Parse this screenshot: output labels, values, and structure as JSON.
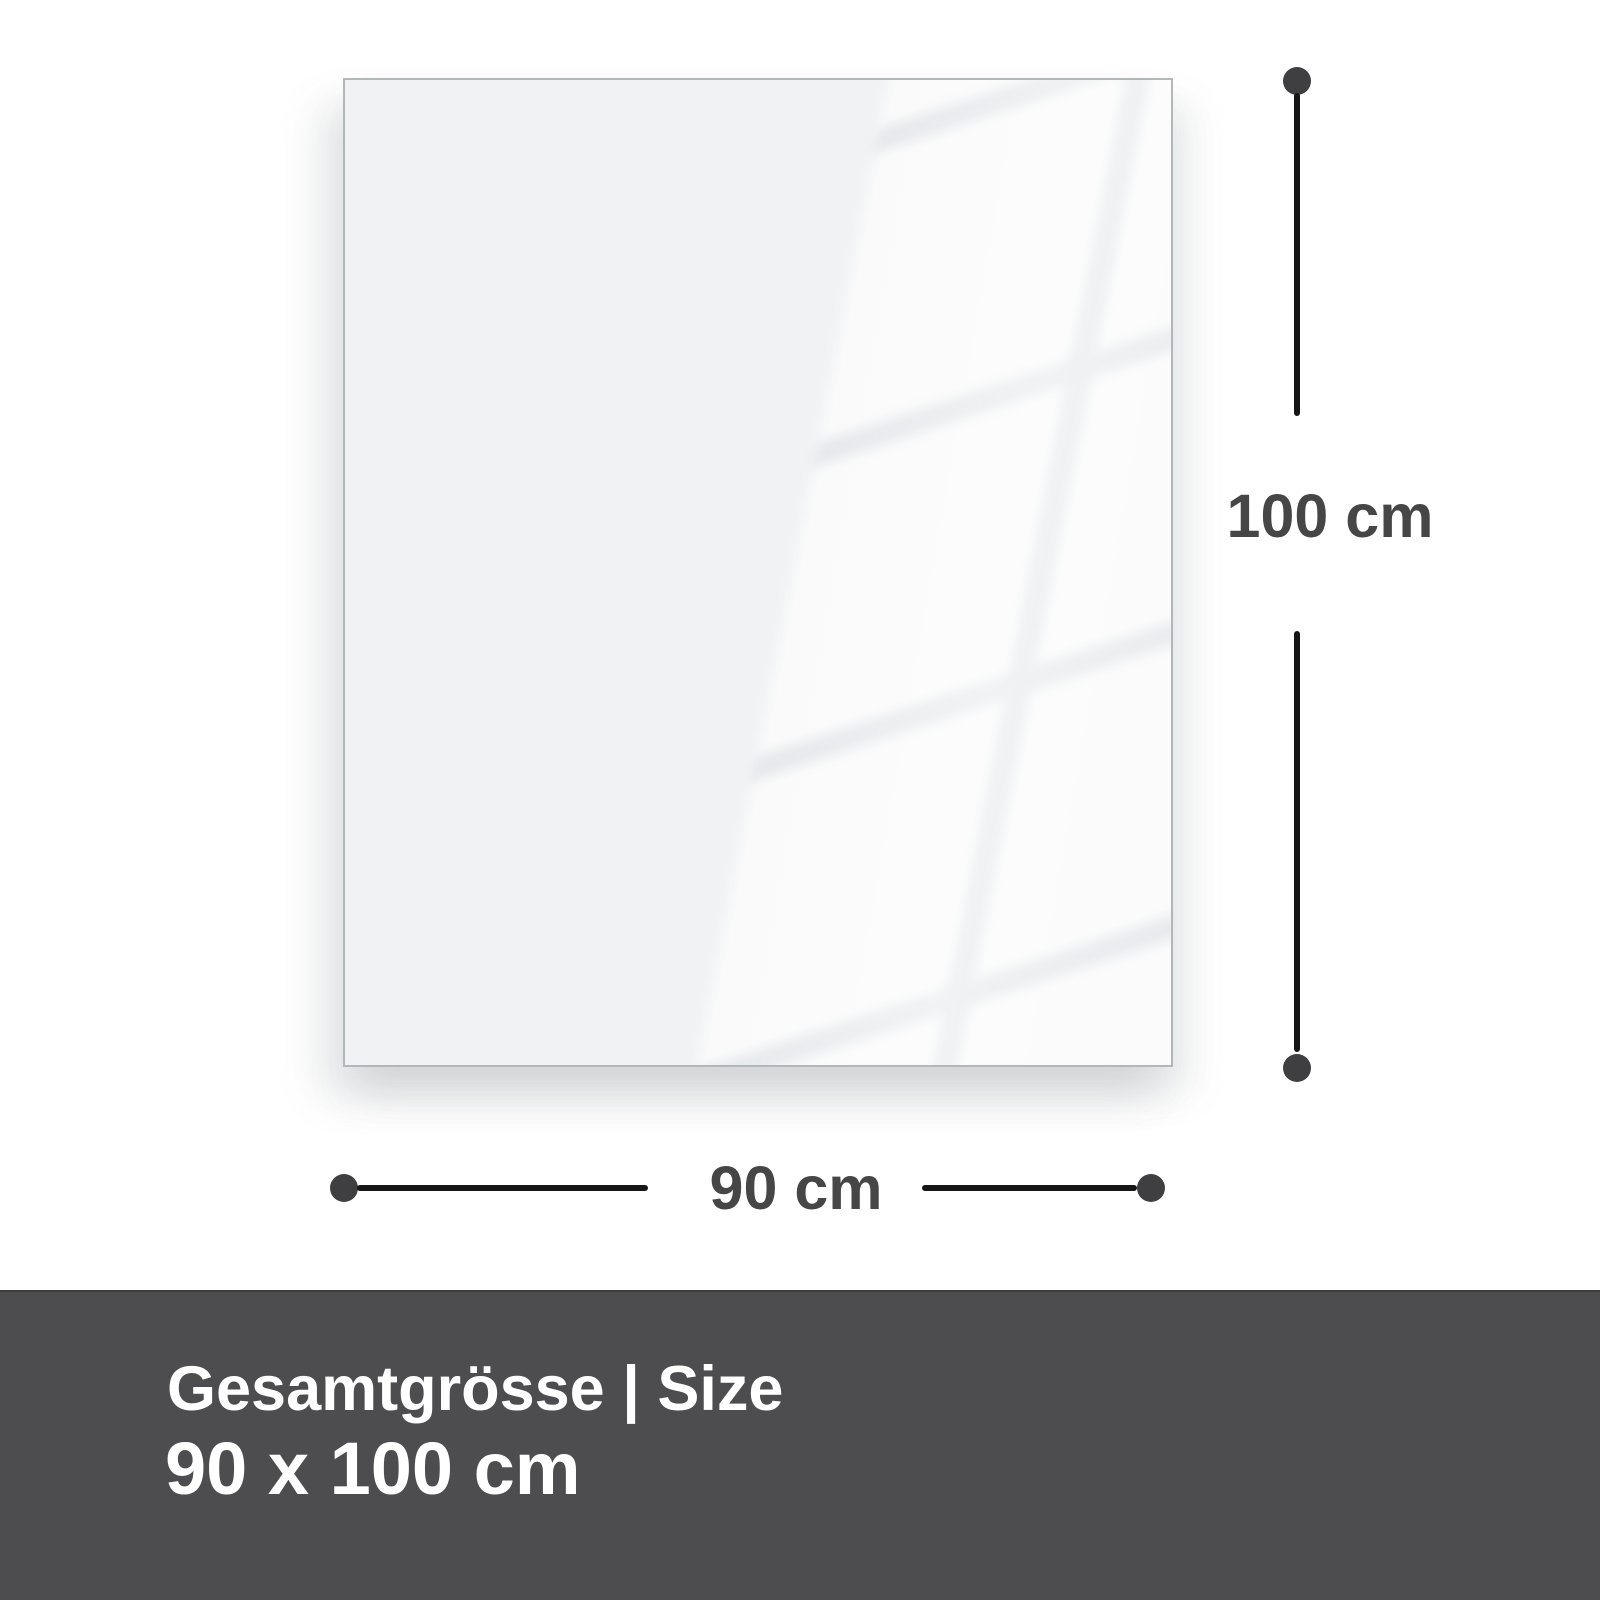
{
  "diagram": {
    "height_dimension": {
      "label": "100 cm"
    },
    "width_dimension": {
      "label": "90 cm"
    }
  },
  "footer": {
    "title": "Gesamtgrösse | Size",
    "size": "90 x 100 cm"
  },
  "colors": {
    "panel_fill": "#f1f2f4",
    "panel_border": "#b2b7ba",
    "line_color": "#161616",
    "dot_color": "#3f3f41",
    "dim_text": "#464646",
    "footer_bg": "#4d4d4f",
    "footer_border": "#3c3c3e",
    "footer_text": "#ffffff"
  }
}
